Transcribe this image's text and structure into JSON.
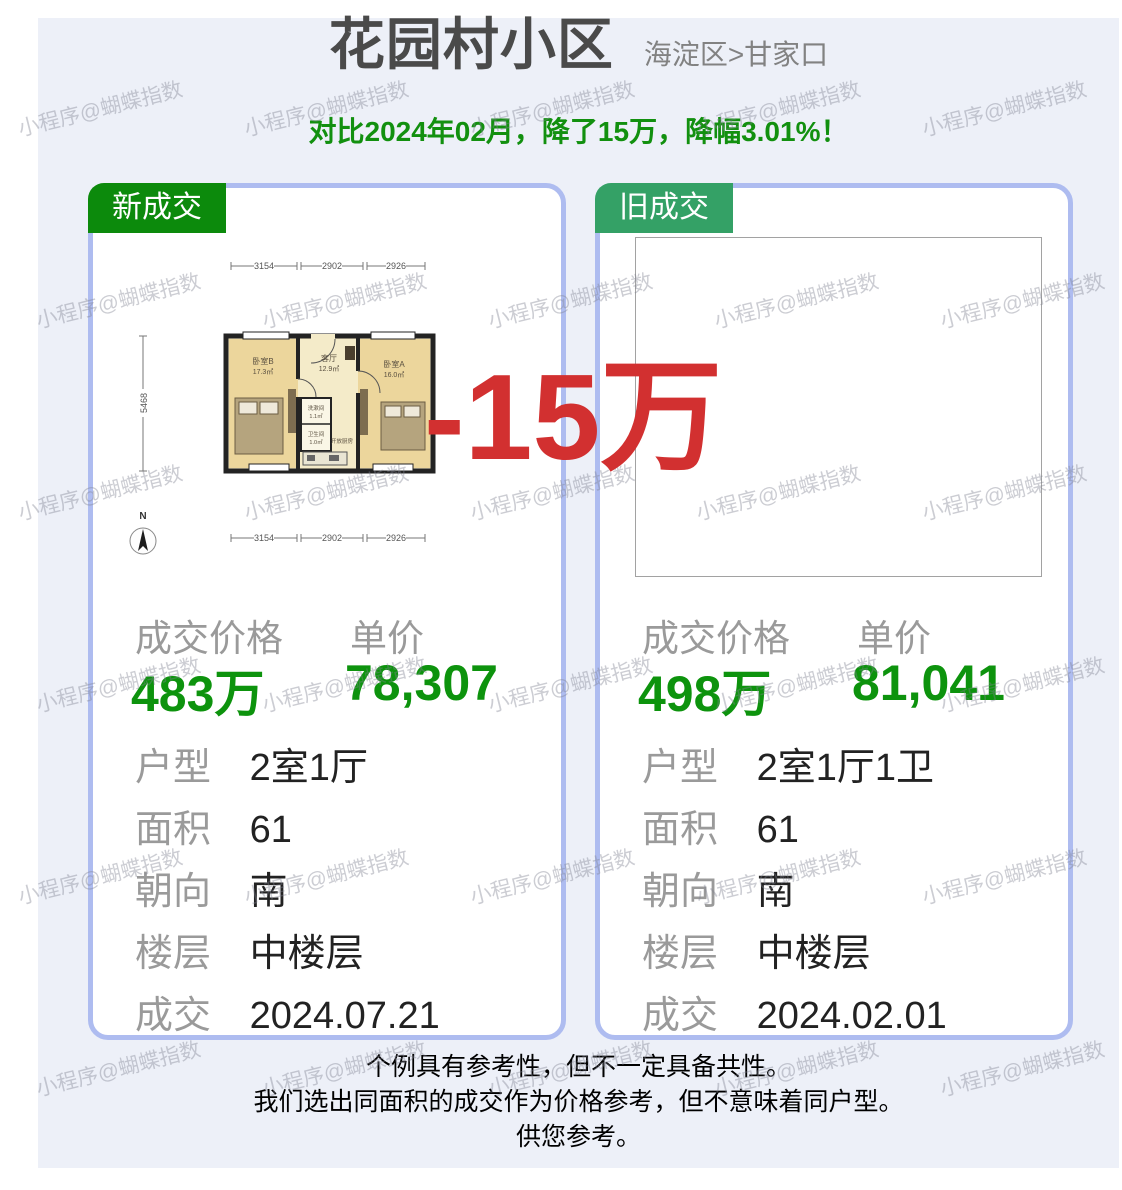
{
  "header": {
    "title": "花园村小区",
    "location": "海淀区>甘家口",
    "compare_note": "对比2024年02月，降了15万，降幅3.01%！"
  },
  "overlay": {
    "drop_text": "-15万"
  },
  "watermark": {
    "text": "小程序@蝴蝶指数"
  },
  "cards": [
    {
      "tag": "新成交",
      "price_label": "成交价格",
      "price_value": "483万",
      "unit_label": "单价",
      "unit_value": "78,307",
      "details": [
        {
          "label": "户型",
          "value": "2室1厅"
        },
        {
          "label": "面积",
          "value": "61"
        },
        {
          "label": "朝向",
          "value": "南"
        },
        {
          "label": "楼层",
          "value": "中楼层"
        },
        {
          "label": "成交",
          "value": "2024.07.21"
        }
      ]
    },
    {
      "tag": "旧成交",
      "price_label": "成交价格",
      "price_value": "498万",
      "unit_label": "单价",
      "unit_value": "81,041",
      "details": [
        {
          "label": "户型",
          "value": "2室1厅1卫"
        },
        {
          "label": "面积",
          "value": "61"
        },
        {
          "label": "朝向",
          "value": "南"
        },
        {
          "label": "楼层",
          "value": "中楼层"
        },
        {
          "label": "成交",
          "value": "2024.02.01"
        }
      ]
    }
  ],
  "floorplan": {
    "dim_top": [
      "3154",
      "2902",
      "2926"
    ],
    "dim_bottom": [
      "3154",
      "2902",
      "2926"
    ],
    "dim_left": "5468",
    "compass": "N",
    "rooms": {
      "bedroomB": "卧室B",
      "bedroomB_area": "17.3㎡",
      "living": "客厅",
      "living_area": "12.9㎡",
      "bedroomA": "卧室A",
      "bedroomA_area": "16.0㎡",
      "wash": "洗漱间",
      "wash_area": "1.1㎡",
      "toilet": "卫生间",
      "toilet_area": "1.0㎡",
      "kitchen": "开放厨房"
    }
  },
  "footer": {
    "line1": "个例具有参考性，但不一定具备共性。",
    "line2": "我们选出同面积的成交作为价格参考，但不意味着同户型。",
    "line3": "供您参考。"
  },
  "colors": {
    "tag_new": "#0c8a0c",
    "tag_old": "#34a166",
    "price_green": "#0d930d",
    "banner_green": "#12900f",
    "drop_red": "#d23030",
    "card_border": "#aebcf0",
    "panel_bg": "#edf0f8"
  }
}
